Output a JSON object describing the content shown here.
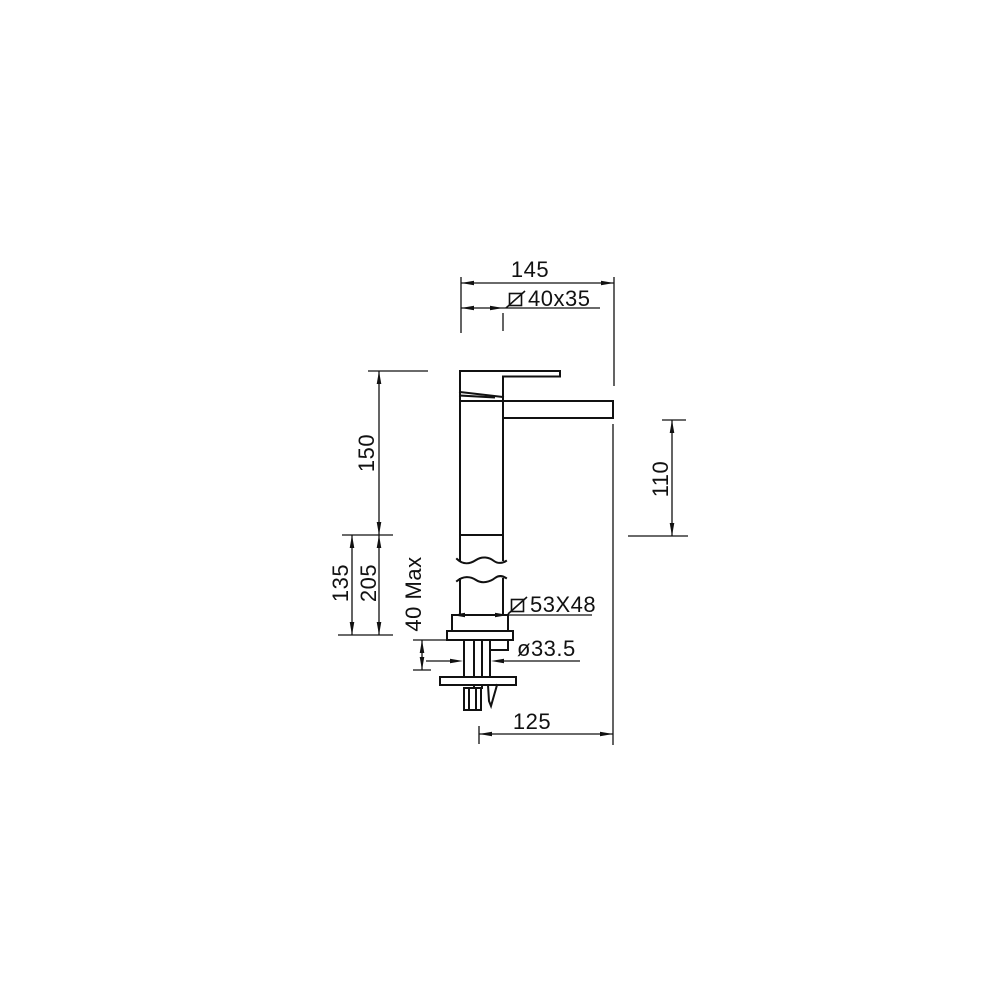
{
  "drawing": {
    "type": "technical-dimension-drawing",
    "subject": "tall single-lever basin faucet, side elevation",
    "colors": {
      "background": "#ffffff",
      "line": "#111111"
    },
    "dims": {
      "overall_width": "145",
      "spout_section": "40x35",
      "spout_section_symbol": "slashed-square-diameter",
      "height_to_rim": "150",
      "outlet_height": "110",
      "rim_offset": "135",
      "total_height": "205",
      "deck_thickness_max": "40 Max",
      "base_section": "53X48",
      "base_section_symbol": "slashed-square-diameter",
      "shank_diameter": "ø33.5",
      "spout_reach": "125"
    }
  }
}
